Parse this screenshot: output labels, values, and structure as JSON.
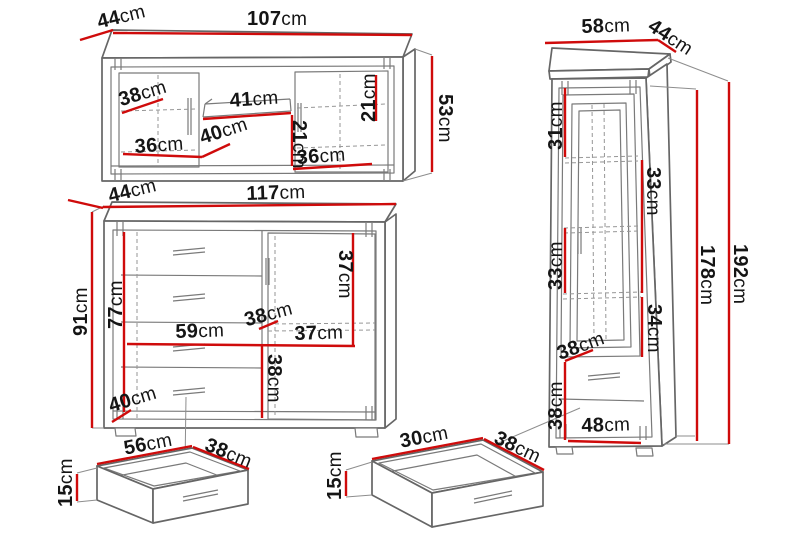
{
  "unit": "cm",
  "colors": {
    "dimension_line": "#cf0b0b",
    "outline": "#666666",
    "label_text": "#151515",
    "background": "#ffffff"
  },
  "pieces": {
    "sideboard": {
      "dims": {
        "width": {
          "num": "107",
          "unit": "cm"
        },
        "depth": {
          "num": "44",
          "unit": "cm"
        },
        "height": {
          "num": "53",
          "unit": "cm"
        },
        "left_inner_depth": {
          "num": "38",
          "unit": "cm"
        },
        "shelf_width": {
          "num": "41",
          "unit": "cm"
        },
        "right_inner_height": {
          "num": "21",
          "unit": "cm"
        },
        "niche_height": {
          "num": "21",
          "unit": "cm"
        },
        "left_inner_width": {
          "num": "36",
          "unit": "cm"
        },
        "niche_depth": {
          "num": "40",
          "unit": "cm"
        },
        "right_inner_width": {
          "num": "36",
          "unit": "cm"
        }
      }
    },
    "chest": {
      "dims": {
        "width": {
          "num": "117",
          "unit": "cm"
        },
        "depth": {
          "num": "44",
          "unit": "cm"
        },
        "height": {
          "num": "91",
          "unit": "cm"
        },
        "inner_height": {
          "num": "77",
          "unit": "cm"
        },
        "drawers_width": {
          "num": "59",
          "unit": "cm"
        },
        "door_inner_width": {
          "num": "37",
          "unit": "cm"
        },
        "door_shelf_depth": {
          "num": "38",
          "unit": "cm"
        },
        "door_upper_height": {
          "num": "37",
          "unit": "cm"
        },
        "door_lower_height": {
          "num": "38",
          "unit": "cm"
        },
        "base_depth": {
          "num": "40",
          "unit": "cm"
        }
      }
    },
    "cabinet": {
      "dims": {
        "width": {
          "num": "58",
          "unit": "cm"
        },
        "depth": {
          "num": "44",
          "unit": "cm"
        },
        "glass_top": {
          "num": "31",
          "unit": "cm"
        },
        "glass_upper": {
          "num": "33",
          "unit": "cm"
        },
        "glass_lower": {
          "num": "33",
          "unit": "cm"
        },
        "glass_bottom": {
          "num": "34",
          "unit": "cm"
        },
        "inner_depth": {
          "num": "38",
          "unit": "cm"
        },
        "drawer_section": {
          "num": "38",
          "unit": "cm"
        },
        "inner_width": {
          "num": "48",
          "unit": "cm"
        },
        "inner_height": {
          "num": "178",
          "unit": "cm"
        },
        "total_height": {
          "num": "192",
          "unit": "cm"
        }
      }
    },
    "drawer_left": {
      "dims": {
        "width": {
          "num": "56",
          "unit": "cm"
        },
        "depth": {
          "num": "38",
          "unit": "cm"
        },
        "height": {
          "num": "15",
          "unit": "cm"
        }
      }
    },
    "drawer_right": {
      "dims": {
        "width": {
          "num": "30",
          "unit": "cm"
        },
        "depth": {
          "num": "38",
          "unit": "cm"
        },
        "height": {
          "num": "15",
          "unit": "cm"
        }
      }
    }
  }
}
